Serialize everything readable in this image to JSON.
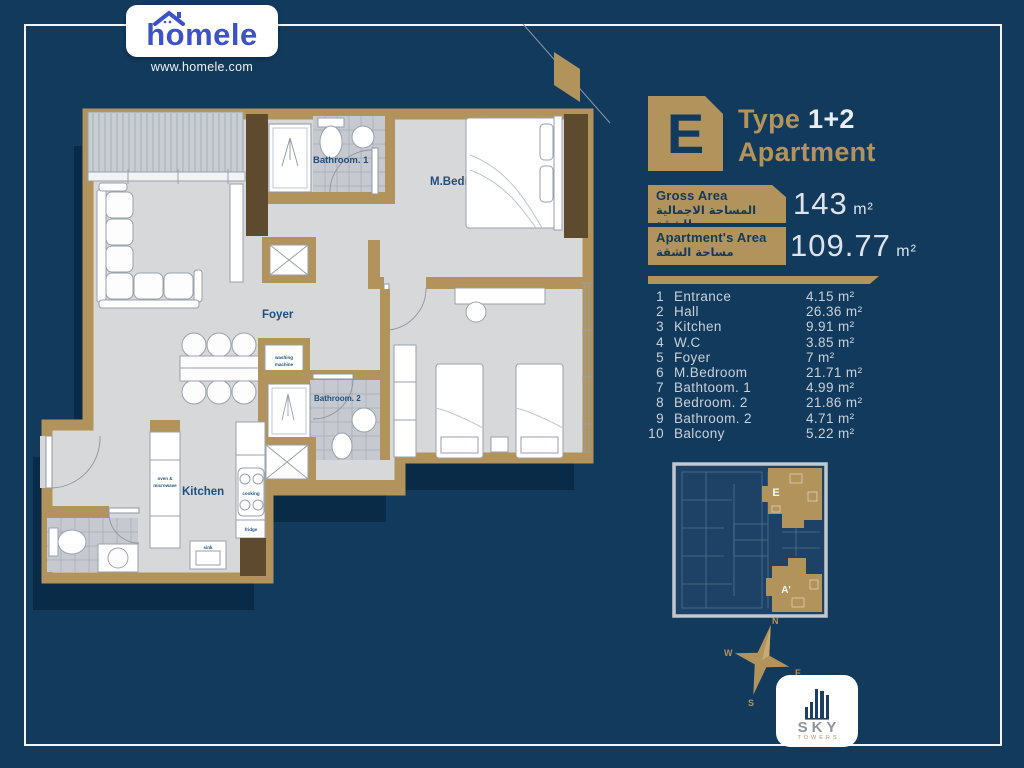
{
  "brand": {
    "logo_text": "homele",
    "website": "www.homele.com"
  },
  "unit": {
    "letter": "E",
    "type_label": "Type",
    "type_value": "1+2",
    "category": "Apartment"
  },
  "areas": {
    "gross": {
      "label_en": "Gross Area",
      "label_ar": "المساحة الاجمالية للشقة",
      "value": "143",
      "unit": "m²"
    },
    "apartment": {
      "label_en": "Apartment's Area",
      "label_ar": "مساحة الشقة",
      "value": "109.77",
      "unit": "m²"
    }
  },
  "rooms": [
    {
      "no": "1",
      "name": "Entrance",
      "area": "4.15 m²"
    },
    {
      "no": "2",
      "name": "Hall",
      "area": "26.36 m²"
    },
    {
      "no": "3",
      "name": "Kitchen",
      "area": "9.91 m²"
    },
    {
      "no": "4",
      "name": "W.C",
      "area": "3.85 m²"
    },
    {
      "no": "5",
      "name": "Foyer",
      "area": "7 m²"
    },
    {
      "no": "6",
      "name": "M.Bedroom",
      "area": "21.71 m²"
    },
    {
      "no": "7",
      "name": "Bathtoom. 1",
      "area": "4.99 m²"
    },
    {
      "no": "8",
      "name": "Bedroom. 2",
      "area": "21.86 m²"
    },
    {
      "no": "9",
      "name": "Bathroom. 2",
      "area": "4.71 m²"
    },
    {
      "no": "10",
      "name": "Balcony",
      "area": "5.22 m²"
    }
  ],
  "plan": {
    "labels": {
      "bathroom1": "Bathroom. 1",
      "mbedroom": "M.Bedroom",
      "foyer": "Foyer",
      "bathroom2": "Bathroom. 2",
      "kitchen": "Kitchen",
      "oven1": "oven &",
      "oven2": "microwave",
      "cooking": "cooking",
      "sink": "sink",
      "washer1": "washing",
      "washer2": "machine",
      "fridge": "fridge"
    }
  },
  "mini_plan": {
    "unit_top": "E",
    "unit_bottom": "A'"
  },
  "compass": {
    "n": "N",
    "e": "E",
    "s": "S",
    "w": "W"
  },
  "developer": {
    "name": "SKY",
    "sub": "TOWERS"
  },
  "colors": {
    "background": "#123a5d",
    "gold": "#b2935c",
    "floor": "#d7d8da",
    "navy_label": "#1d5080"
  }
}
